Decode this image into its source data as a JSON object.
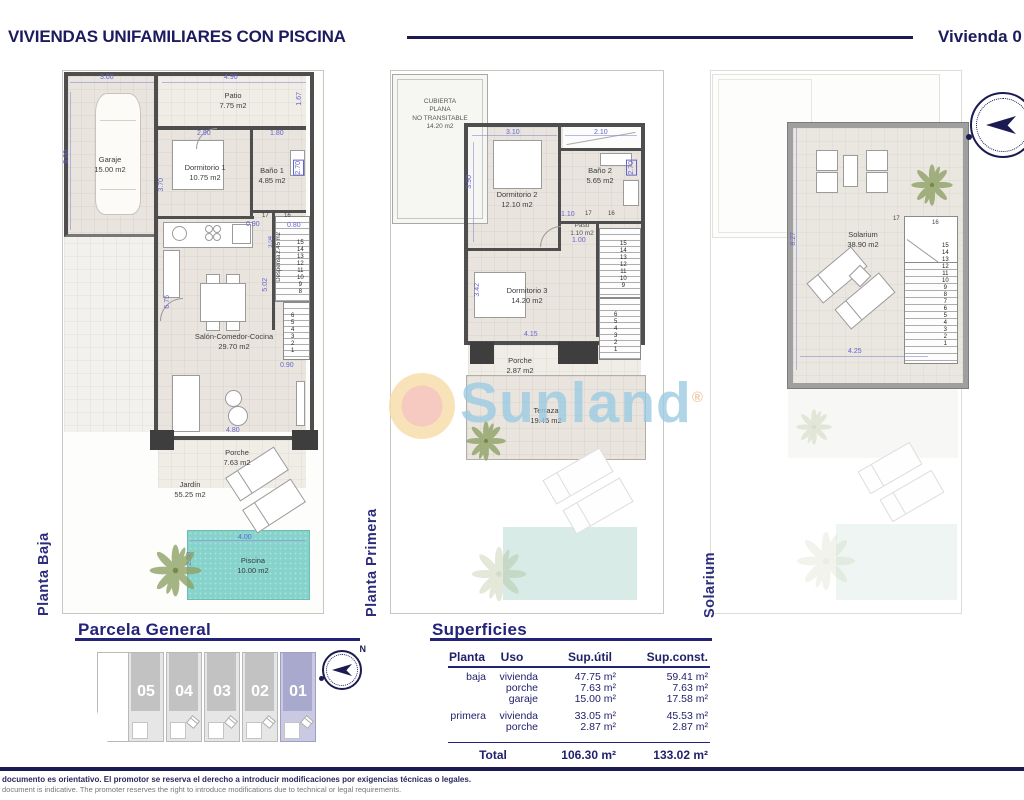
{
  "header": {
    "title": "VIVIENDAS UNIFAMILIARES CON PISCINA",
    "unit": "Vivienda 0"
  },
  "watermark": {
    "brand": "Sunland",
    "reg": "®"
  },
  "floors": {
    "baja": {
      "label": "Planta Baja",
      "garaje_name": "Garaje",
      "garaje_area": "15.00 m2",
      "patio_name": "Patio",
      "patio_area": "7.75 m2",
      "dorm1_name": "Dormitorio 1",
      "dorm1_area": "10.75 m2",
      "bano1_name": "Baño 1",
      "bano1_area": "4.85 m2",
      "despensa_name": "Despensa",
      "despensa_area": "2.45 m2",
      "salon_name": "Salón-Comedor-Cocina",
      "salon_area": "29.70 m2",
      "porche_name": "Porche",
      "porche_area": "7.63 m2",
      "jardin_name": "Jardín",
      "jardin_area": "55.25 m2",
      "piscina_name": "Piscina",
      "piscina_area": "10.00 m2",
      "dims": {
        "garage_w": "3.00",
        "patio_w": "4.90",
        "patio_d": "1.67",
        "garage_d": "5.00",
        "dorm1_d": "3.70",
        "dorm1_w": "2.90",
        "bano1_w": "1.80",
        "bano1_d": "2.70",
        "hall": "0.90",
        "stair_w": "0.80",
        "stair_d": "3.04",
        "right_d": "5.02",
        "left_d": "6.75",
        "door": "0.90",
        "salon_w": "4.80",
        "pool_w": "4.00",
        "pool_d": "2.50"
      },
      "stair17": "17",
      "stair16": "16",
      "stairs_upper": [
        "15",
        "14",
        "13",
        "12",
        "11",
        "10",
        "9",
        "8"
      ],
      "stairs_lower": [
        "6",
        "5",
        "4",
        "3",
        "2",
        "1"
      ]
    },
    "primera": {
      "label": "Planta Primera",
      "cubierta": [
        "CUBIERTA",
        "PLANA",
        "NO TRANSITABLE",
        "14.20 m2"
      ],
      "dorm2_name": "Dormitorio 2",
      "dorm2_area": "12.10 m2",
      "bano2_name": "Baño 2",
      "bano2_area": "5.65 m2",
      "paso_name": "Paso",
      "paso_area": "1.10 m2",
      "dorm3_name": "Dormitorio 3",
      "dorm3_area": "14.20 m2",
      "porche_name": "Porche",
      "porche_area": "2.87 m2",
      "terraza_name": "Terraza",
      "terraza_area": "19.45 m2",
      "dims": {
        "dorm2_w": "3.10",
        "bano2_w": "2.10",
        "dorm2_d": "3.90",
        "bano2_d": "2.70",
        "paso_w": "1.10",
        "door": "1.00",
        "dorm3_d": "3.42",
        "dorm3_w": "4.15"
      },
      "stair17": "17",
      "stair16": "16",
      "stairs_upper": [
        "15",
        "14",
        "13",
        "12",
        "11",
        "10",
        "9"
      ],
      "stairs_lower": [
        "6",
        "5",
        "4",
        "3",
        "2",
        "1"
      ]
    },
    "solarium": {
      "label": "Solarium",
      "name": "Solarium",
      "area": "38.90 m2",
      "dims": {
        "depth": "8.27",
        "width": "4.25"
      },
      "stair17": "17",
      "stair16": "16",
      "stairs": [
        "15",
        "14",
        "13",
        "12",
        "11",
        "10",
        "9",
        "8",
        "7",
        "6",
        "5",
        "4",
        "3",
        "2",
        "1"
      ]
    }
  },
  "parcela": {
    "title": "Parcela General",
    "units": [
      "05",
      "04",
      "03",
      "02",
      "01"
    ],
    "north": "N"
  },
  "superficies": {
    "title": "Superficies",
    "col_planta": "Planta",
    "col_uso": "Uso",
    "col_util": "Sup.útil",
    "col_const": "Sup.const.",
    "rows": [
      {
        "planta": "baja",
        "uso": "vivienda",
        "util": "47.75 m²",
        "const": "59.41 m²"
      },
      {
        "planta": "",
        "uso": "porche",
        "util": "7.63 m²",
        "const": "7.63 m²"
      },
      {
        "planta": "",
        "uso": "garaje",
        "util": "15.00 m²",
        "const": "17.58 m²"
      },
      {
        "planta": "primera",
        "uso": "vivienda",
        "util": "33.05 m²",
        "const": "45.53 m²"
      },
      {
        "planta": "",
        "uso": "porche",
        "util": "2.87 m²",
        "const": "2.87 m²"
      }
    ],
    "total_label": "Total",
    "total_util": "106.30 m²",
    "total_const": "133.02 m²"
  },
  "footer": {
    "line_es": "documento es orientativo. El promotor se reserva el derecho a introducir modificaciones por exigencias técnicas o legales.",
    "line_en": "document is indicative. The promoter reserves the right to introduce modifications due to technical or legal requirements."
  }
}
